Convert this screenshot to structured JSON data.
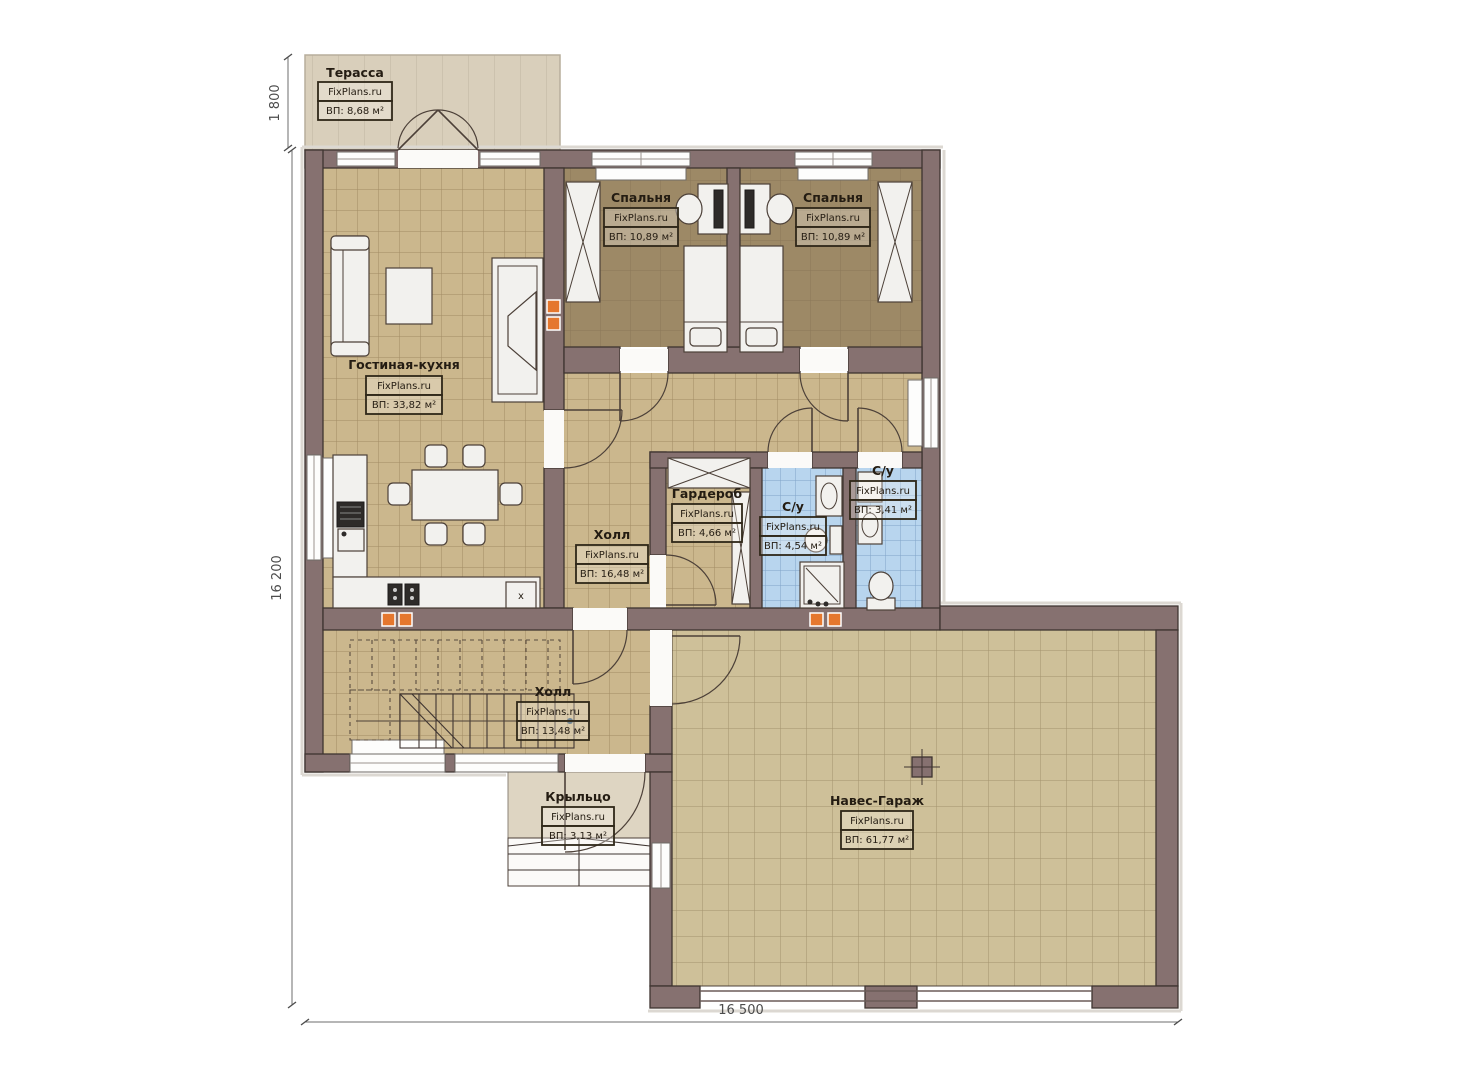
{
  "site": "FixPlans.ru",
  "colors": {
    "wall": "#867170",
    "floor_tile": "#cbb78d",
    "bedroom_floor": "#9d8966",
    "bathroom_floor": "#b8d5ee",
    "terrace_floor": "#d9cfbb",
    "porch_floor": "#ded5c2",
    "garage_floor": "#cec099",
    "accent_marker": "#e5772e"
  },
  "rooms": [
    {
      "id": "terrace",
      "name": "Терасса",
      "area": "ВП: 8,68 м²"
    },
    {
      "id": "bedroom1",
      "name": "Спальня",
      "area": "ВП: 10,89 м²"
    },
    {
      "id": "bedroom2",
      "name": "Спальня",
      "area": "ВП: 10,89 м²"
    },
    {
      "id": "living",
      "name": "Гостиная-кухня",
      "area": "ВП: 33,82 м²"
    },
    {
      "id": "wardrobe",
      "name": "Гардероб",
      "area": "ВП: 4,66 м²"
    },
    {
      "id": "bath1",
      "name": "С/у",
      "area": "ВП: 4,54 м²"
    },
    {
      "id": "bath2",
      "name": "С/у",
      "area": "ВП: 3,41 м²"
    },
    {
      "id": "hall_up",
      "name": "Холл",
      "area": "ВП: 16,48 м²"
    },
    {
      "id": "hall_low",
      "name": "Холл",
      "area": "ВП: 13,48 м²"
    },
    {
      "id": "porch",
      "name": "Крыльцо",
      "area": "ВП: 3,13 м²"
    },
    {
      "id": "garage",
      "name": "Навес-Гараж",
      "area": "ВП: 61,77 м²"
    }
  ],
  "dimensions": {
    "terrace_depth": "1 800",
    "house_side": "16 200",
    "total_width": "16 500"
  },
  "kitchen": {
    "box_label": "x"
  }
}
